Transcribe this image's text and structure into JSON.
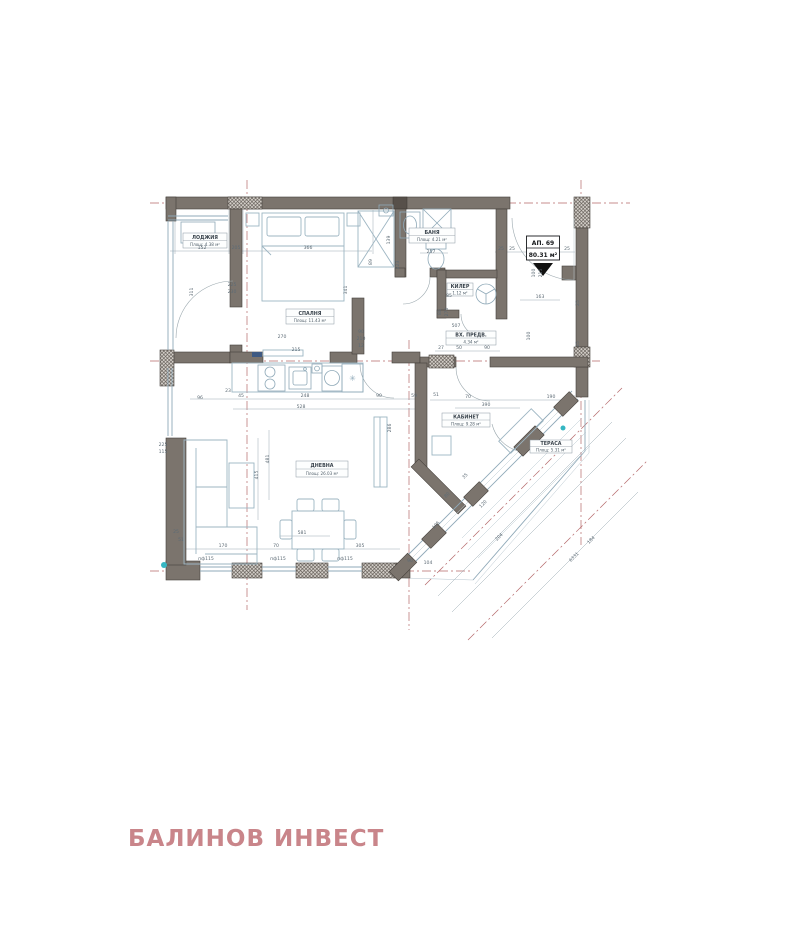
{
  "document": {
    "type": "architectural floor plan"
  },
  "company": {
    "name": "БАЛИНОВ ИНВЕСТ",
    "brand_color": "#c9858a"
  },
  "apartment": {
    "label": "АП. 69",
    "area": "80.31 м²"
  },
  "rooms": [
    {
      "name": "ЛОДЖИЯ",
      "area": "Площ: 4.38 м²"
    },
    {
      "name": "СПАЛНЯ",
      "area": "Площ: 11.43 м²"
    },
    {
      "name": "БАНЯ",
      "area": "Площ: 4.21 м²"
    },
    {
      "name": "КИЛЕР",
      "area": "1.12 м²"
    },
    {
      "name": "ВХ. ПРЕДВ.",
      "area": "4.34 м²"
    },
    {
      "name": "ДНЕВНА",
      "area": "Площ: 26.03 м²"
    },
    {
      "name": "КАБИНЕТ",
      "area": "Площ: 9.28 м²"
    },
    {
      "name": "ТЕРАСА",
      "area": "Площ: 5.31 м²"
    }
  ],
  "icons": {
    "snowflake": "✳"
  },
  "colors": {
    "wall": "#7b746d",
    "axis_red": "#b5686a",
    "furniture_blue": "#9db5c2",
    "accent_teal": "#35b6c2"
  },
  "dimension_labels": [
    {
      "t": "152",
      "x": 202,
      "y": 249,
      "r": 0
    },
    {
      "t": "205",
      "x": 236,
      "y": 249,
      "r": 0
    },
    {
      "t": "366",
      "x": 308,
      "y": 249,
      "r": 0
    },
    {
      "t": "225",
      "x": 232,
      "y": 286,
      "r": 0
    },
    {
      "t": "230",
      "x": 232,
      "y": 293,
      "r": 0
    },
    {
      "t": "311",
      "x": 193,
      "y": 292,
      "r": -90
    },
    {
      "t": "341",
      "x": 347,
      "y": 290,
      "r": -90
    },
    {
      "t": "89",
      "x": 372,
      "y": 262,
      "r": -90
    },
    {
      "t": "139",
      "x": 390,
      "y": 240,
      "r": -90
    },
    {
      "t": "223",
      "x": 399,
      "y": 265,
      "r": -90
    },
    {
      "t": "257",
      "x": 431,
      "y": 253,
      "r": 0
    },
    {
      "t": "270",
      "x": 282,
      "y": 338,
      "r": 0
    },
    {
      "t": "215",
      "x": 296,
      "y": 351,
      "r": 0
    },
    {
      "t": "90",
      "x": 361,
      "y": 333,
      "r": 0
    },
    {
      "t": "210",
      "x": 361,
      "y": 340,
      "r": 0
    },
    {
      "t": "12",
      "x": 361,
      "y": 347,
      "r": 0
    },
    {
      "t": "25",
      "x": 501,
      "y": 250,
      "r": 0
    },
    {
      "t": "25",
      "x": 512,
      "y": 250,
      "r": 0
    },
    {
      "t": "25",
      "x": 567,
      "y": 250,
      "r": 0
    },
    {
      "t": "100",
      "x": 535,
      "y": 273,
      "r": -90
    },
    {
      "t": "215",
      "x": 542,
      "y": 273,
      "r": -90
    },
    {
      "t": "163",
      "x": 540,
      "y": 298,
      "r": 0
    },
    {
      "t": "25",
      "x": 579,
      "y": 303,
      "r": -90
    },
    {
      "t": "25",
      "x": 579,
      "y": 344,
      "r": -90
    },
    {
      "t": "85",
      "x": 449,
      "y": 297,
      "r": 0
    },
    {
      "t": "88",
      "x": 441,
      "y": 312,
      "r": -90
    },
    {
      "t": "270",
      "x": 448,
      "y": 312,
      "r": -90
    },
    {
      "t": "507",
      "x": 456,
      "y": 327,
      "r": 0
    },
    {
      "t": "100",
      "x": 530,
      "y": 336,
      "r": -90
    },
    {
      "t": "27",
      "x": 441,
      "y": 349,
      "r": 0
    },
    {
      "t": "50",
      "x": 459,
      "y": 349,
      "r": 0
    },
    {
      "t": "90",
      "x": 487,
      "y": 349,
      "r": 0
    },
    {
      "t": "96",
      "x": 200,
      "y": 399,
      "r": 0
    },
    {
      "t": "23",
      "x": 228,
      "y": 392,
      "r": 0
    },
    {
      "t": "45",
      "x": 241,
      "y": 397,
      "r": 0
    },
    {
      "t": "248",
      "x": 305,
      "y": 397,
      "r": 0
    },
    {
      "t": "90",
      "x": 379,
      "y": 397,
      "r": 0
    },
    {
      "t": "59",
      "x": 414,
      "y": 397,
      "r": 0
    },
    {
      "t": "528",
      "x": 301,
      "y": 408,
      "r": 0
    },
    {
      "t": "51",
      "x": 436,
      "y": 396,
      "r": 0
    },
    {
      "t": "70",
      "x": 468,
      "y": 398,
      "r": 0
    },
    {
      "t": "390",
      "x": 486,
      "y": 406,
      "r": 0
    },
    {
      "t": "190",
      "x": 551,
      "y": 398,
      "r": 0
    },
    {
      "t": "286",
      "x": 391,
      "y": 428,
      "r": -90
    },
    {
      "t": "415",
      "x": 258,
      "y": 475,
      "r": -90
    },
    {
      "t": "481",
      "x": 269,
      "y": 459,
      "r": -90
    },
    {
      "t": "225",
      "x": 163,
      "y": 446,
      "r": 0
    },
    {
      "t": "115",
      "x": 163,
      "y": 453,
      "r": 0
    },
    {
      "t": "25",
      "x": 176,
      "y": 533,
      "r": 0
    },
    {
      "t": "51",
      "x": 181,
      "y": 541,
      "r": 0
    },
    {
      "t": "170",
      "x": 223,
      "y": 547,
      "r": 0
    },
    {
      "t": "70",
      "x": 276,
      "y": 547,
      "r": 0
    },
    {
      "t": "581",
      "x": 302,
      "y": 534,
      "r": 0
    },
    {
      "t": "305",
      "x": 360,
      "y": 547,
      "r": 0
    },
    {
      "t": "пф115",
      "x": 206,
      "y": 560,
      "r": 0
    },
    {
      "t": "пф115",
      "x": 278,
      "y": 560,
      "r": 0
    },
    {
      "t": "пф115",
      "x": 345,
      "y": 560,
      "r": 0
    },
    {
      "t": "90",
      "x": 410,
      "y": 562,
      "r": 0
    },
    {
      "t": "104",
      "x": 428,
      "y": 564,
      "r": 0
    },
    {
      "t": "35",
      "x": 466,
      "y": 477,
      "r": -45
    },
    {
      "t": "80",
      "x": 448,
      "y": 496,
      "r": -45
    },
    {
      "t": "120",
      "x": 484,
      "y": 505,
      "r": -45
    },
    {
      "t": "105",
      "x": 437,
      "y": 526,
      "r": -45
    },
    {
      "t": "204",
      "x": 500,
      "y": 538,
      "r": -45
    },
    {
      "t": "184",
      "x": 592,
      "y": 541,
      "r": -45
    },
    {
      "t": "6331",
      "x": 575,
      "y": 558,
      "r": -45
    }
  ]
}
